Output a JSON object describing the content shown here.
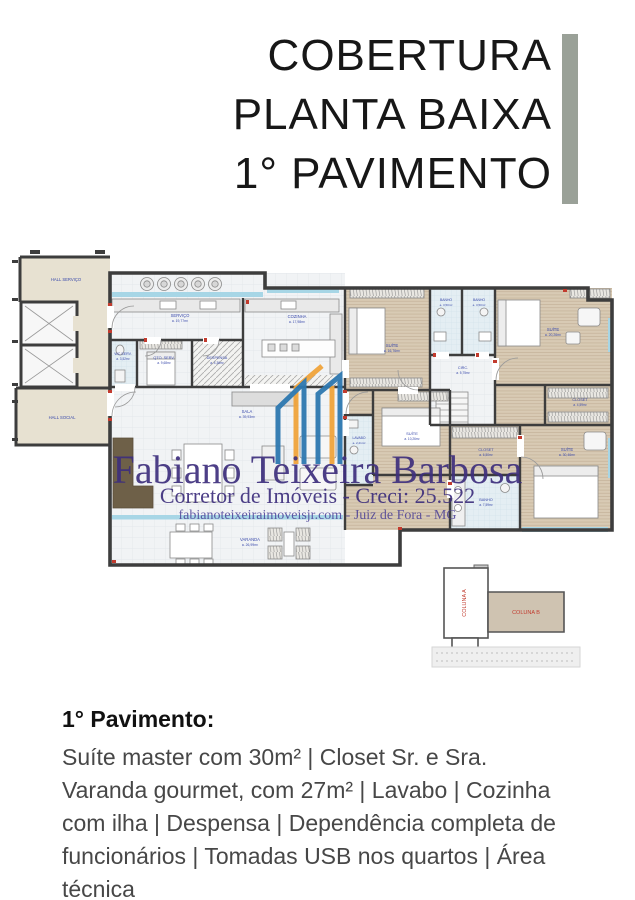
{
  "title": {
    "lines": [
      "COBERTURA",
      "PLANTA BAIXA",
      "1° PAVIMENTO"
    ]
  },
  "watermark": {
    "name": "Fabiano Teixeira Barbosa",
    "role": "Corretor de Imóveis - Creci: 25.522",
    "site": "fabianoteixeiraimoveisjr.com - Juiz de Fora - MG"
  },
  "plan": {
    "rooms": [
      {
        "name": "HALL SERVIÇO",
        "area": ""
      },
      {
        "name": "HALL SOCIAL",
        "area": ""
      },
      {
        "name": "SERVIÇO",
        "area": "a. 19,77m²"
      },
      {
        "name": "WC SERV.",
        "area": "a. 3,52m²"
      },
      {
        "name": "QTO. SERV.",
        "area": "a. 9,68m²"
      },
      {
        "name": "DESPENSA",
        "area": "a. 4,36m²"
      },
      {
        "name": "COZINHA",
        "area": "a. 17,98m²"
      },
      {
        "name": "SALA",
        "area": "a. 39,93m²"
      },
      {
        "name": "VARANDA",
        "area": "a. 26,99m²"
      },
      {
        "name": "SUÍTE",
        "area": "a. 16,76m²"
      },
      {
        "name": "BANHO",
        "area": "a. 3,50m²"
      },
      {
        "name": "BANHO",
        "area": "a. 3,50m²"
      },
      {
        "name": "SUÍTE",
        "area": "a. 20,26m²"
      },
      {
        "name": "CIRC.",
        "area": "a. 5,75m²"
      },
      {
        "name": "CLOSET",
        "area": "a. 4,59m²"
      },
      {
        "name": "SUÍTE",
        "area": "a. 10,26m²"
      },
      {
        "name": "CLOSET",
        "area": "a. 6,50m²"
      },
      {
        "name": "SUÍTE",
        "area": "a. 30,46m²"
      },
      {
        "name": "BANHO",
        "area": "a. 7,59m²"
      },
      {
        "name": "LAVABO",
        "area": "a. 2,21m²"
      }
    ],
    "minimap": {
      "column_a": "COLUNA A",
      "column_b": "COLUNA B"
    }
  },
  "description": {
    "heading": "1° Pavimento:",
    "body": "Suíte master com 30m² | Closet Sr. e Sra. Varanda gourmet, com 27m² | Lavabo | Cozinha com ilha | Despensa | Dependência completa de funcionários | Tomadas USB nos quartos | Área técnica"
  },
  "colors": {
    "accent_bar": "#9aa198",
    "watermark_purple": "#3e2f7d",
    "room_label_blue": "#3949ab",
    "dimension_red": "#c23b2e",
    "wood_floor": "#d8cab4",
    "hall_beige": "#e7e1d1",
    "logo_blue": "#2e78b0",
    "logo_orange": "#f0a43c"
  }
}
